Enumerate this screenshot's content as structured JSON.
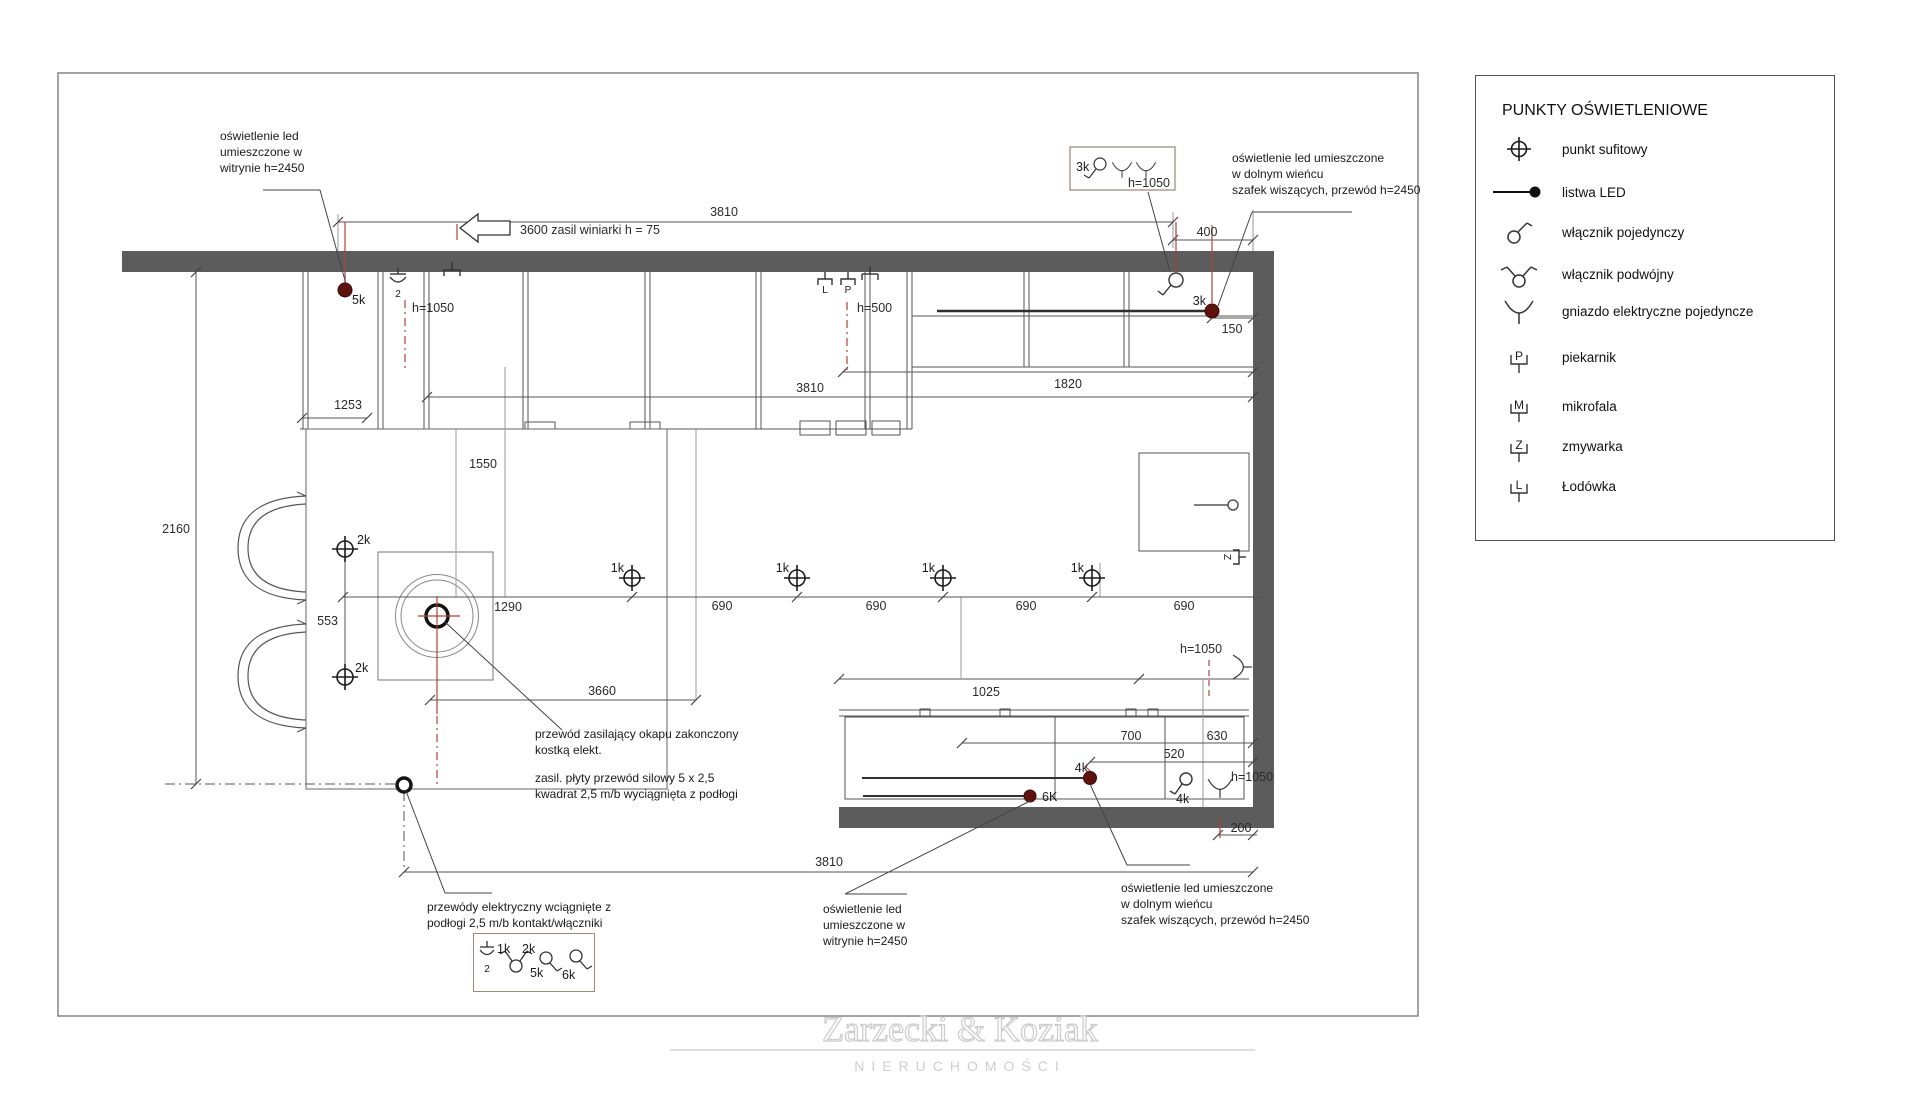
{
  "legend": {
    "title": "PUNKTY OŚWIETLENIOWE",
    "items": [
      {
        "symbol": "ceiling-point",
        "label": "punkt sufitowy"
      },
      {
        "symbol": "led-strip",
        "label": "listwa LED"
      },
      {
        "symbol": "single-switch",
        "label": "włącznik pojedynczy"
      },
      {
        "symbol": "double-switch",
        "label": "włącznik podwójny"
      },
      {
        "symbol": "single-socket",
        "label": "gniazdo elektryczne pojedyncze"
      },
      {
        "symbol": "oven",
        "label": "piekarnik",
        "letter": "P"
      },
      {
        "symbol": "microwave",
        "label": "mikrofala",
        "letter": "M"
      },
      {
        "symbol": "dishwasher",
        "label": "zmywarka",
        "letter": "Z"
      },
      {
        "symbol": "fridge",
        "label": "Łodówka",
        "letter": "L"
      }
    ]
  },
  "annotations": {
    "top_left": "oświetlenie led\numieszczone w\nwitrynie h=2450",
    "top_right": "oświetlenie led umieszczone\nw dolnym wieńcu\nszafek wiszących, przewód h=2450",
    "hood": "przewód zasilający okapu zakonczony\nkostką elekt.",
    "hob_power": "zasil. płyty przewód silowy 5 x 2,5\nkwadrat 2,5 m/b wyciągnięta z podłogi",
    "bottom_left": "przewódy elektryczny wciągnięte z\npodłogi 2,5 m/b kontakt/włączniki",
    "bottom_mid": "oświetlenie led\numieszczone w\nwitrynie h=2450",
    "bottom_right": "oświetlenie led umieszczone\nw dolnym wieńcu\nszafek wiszących, przewód h=2450"
  },
  "dims": {
    "top_3810": "3810",
    "arrow_note": "3600 zasil winiarki  h = 75",
    "d400": "400",
    "d150": "150",
    "d1820": "1820",
    "mid_3810": "3810",
    "d1253": "1253",
    "h1050_topleft": "h=1050",
    "h500": "h=500",
    "d1550": "1550",
    "d2160": "2160",
    "d553": "553",
    "d1290": "1290",
    "d690": "690",
    "d3660": "3660",
    "d1025": "1025",
    "d700": "700",
    "d630": "630",
    "d520": "520",
    "h1050_midright": "h=1050",
    "h1050_bottomright": "h=1050",
    "h1050_box": "h=1050",
    "d200": "200",
    "bottom_3810": "3810"
  },
  "points": {
    "p5k": "5k",
    "p3k_box": "3k",
    "p3k": "3k",
    "p1k": "1k",
    "p2k": "2k",
    "p4k": "4k",
    "p6k": "6K",
    "box_1k": "1k",
    "box_2k": "2k",
    "box_5k": "5k",
    "box_6k": "6k"
  },
  "plan_letters": {
    "fridge": "L",
    "oven": "P",
    "dishwasher": "Z",
    "double_socket": "2"
  },
  "colors": {
    "wall": "#5c5c5c",
    "red_guide": "#b04238",
    "led_dot": "#5f120d"
  },
  "watermark": {
    "name": "Zarzecki & Koziak",
    "subtitle": "NIERUCHOMOŚCI"
  }
}
